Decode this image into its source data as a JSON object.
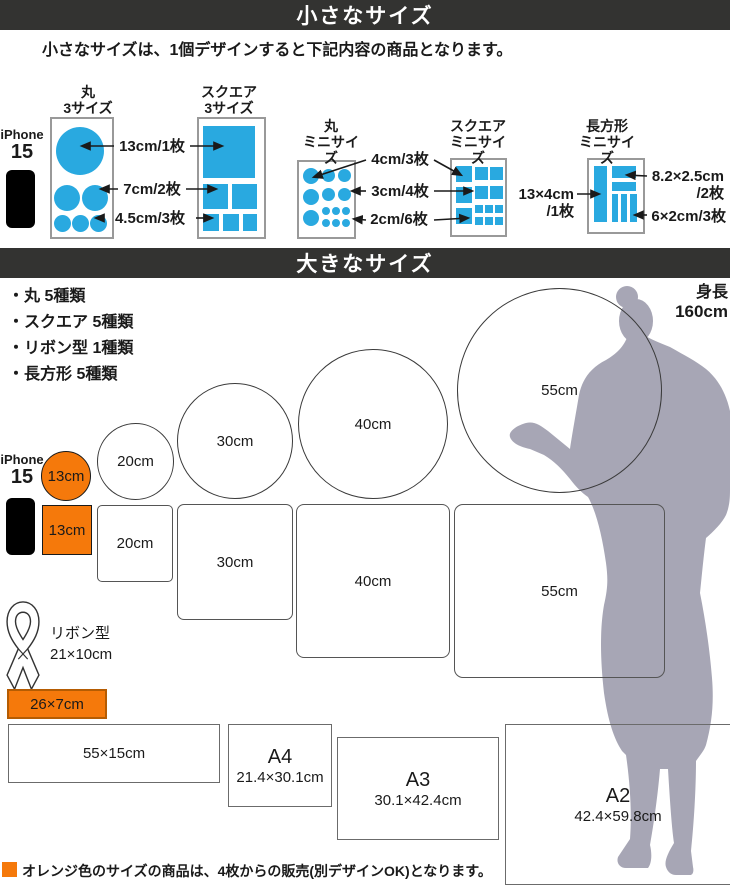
{
  "colors": {
    "blue": "#29A9E0",
    "orange": "#F5790B",
    "header_bg": "#333331",
    "silhouette": "#A7A6B5"
  },
  "small": {
    "header": "小さなサイズ",
    "subtitle": "小さなサイズは、1個デザインすると下記内容の商品となります。",
    "iphone_line1": "iPhone",
    "iphone_line2": "15",
    "round3_t1": "丸",
    "round3_t2": "3サイズ",
    "square3_t1": "スクエア",
    "square3_t2": "3サイズ",
    "label_13cm": "13cm/1枚",
    "label_7cm": "7cm/2枚",
    "label_45cm": "4.5cm/3枚",
    "roundmini_t1": "丸",
    "roundmini_t2": "ミニサイズ",
    "squaremini_t1": "スクエア",
    "squaremini_t2": "ミニサイズ",
    "label_4cm": "4cm/3枚",
    "label_3cm": "3cm/4枚",
    "label_2cm": "2cm/6枚",
    "rectmini_t1": "長方形",
    "rectmini_t2": "ミニサイズ",
    "label_13x4_a": "13×4cm",
    "label_13x4_b": "/1枚",
    "label_82x25_a": "8.2×2.5cm",
    "label_82x25_b": "/2枚",
    "label_6x2": "6×2cm/3枚"
  },
  "large": {
    "header": "大きなサイズ",
    "bullets": [
      "・丸 5種類",
      "・スクエア 5種類",
      "・リボン型 1種類",
      "・長方形 5種類"
    ],
    "height_line1": "身長",
    "height_line2": "160cm",
    "iphone_line1": "iPhone",
    "iphone_line2": "15",
    "circle_13": "13cm",
    "circle_20": "20cm",
    "circle_30": "30cm",
    "circle_40": "40cm",
    "circle_55": "55cm",
    "square_13": "13cm",
    "square_20": "20cm",
    "square_30": "30cm",
    "square_40": "40cm",
    "square_55": "55cm",
    "ribbon_line1": "リボン型",
    "ribbon_line2": "21×10cm",
    "orange_rect_label": "26×7cm",
    "rect_55x15": "55×15cm",
    "a4_name": "A4",
    "a4_size": "21.4×30.1cm",
    "a3_name": "A3",
    "a3_size": "30.1×42.4cm",
    "a2_name": "A2",
    "a2_size": "42.4×59.8cm",
    "note": "オレンジ色のサイズの商品は、4枚からの販売(別デザインOK)となります。"
  }
}
